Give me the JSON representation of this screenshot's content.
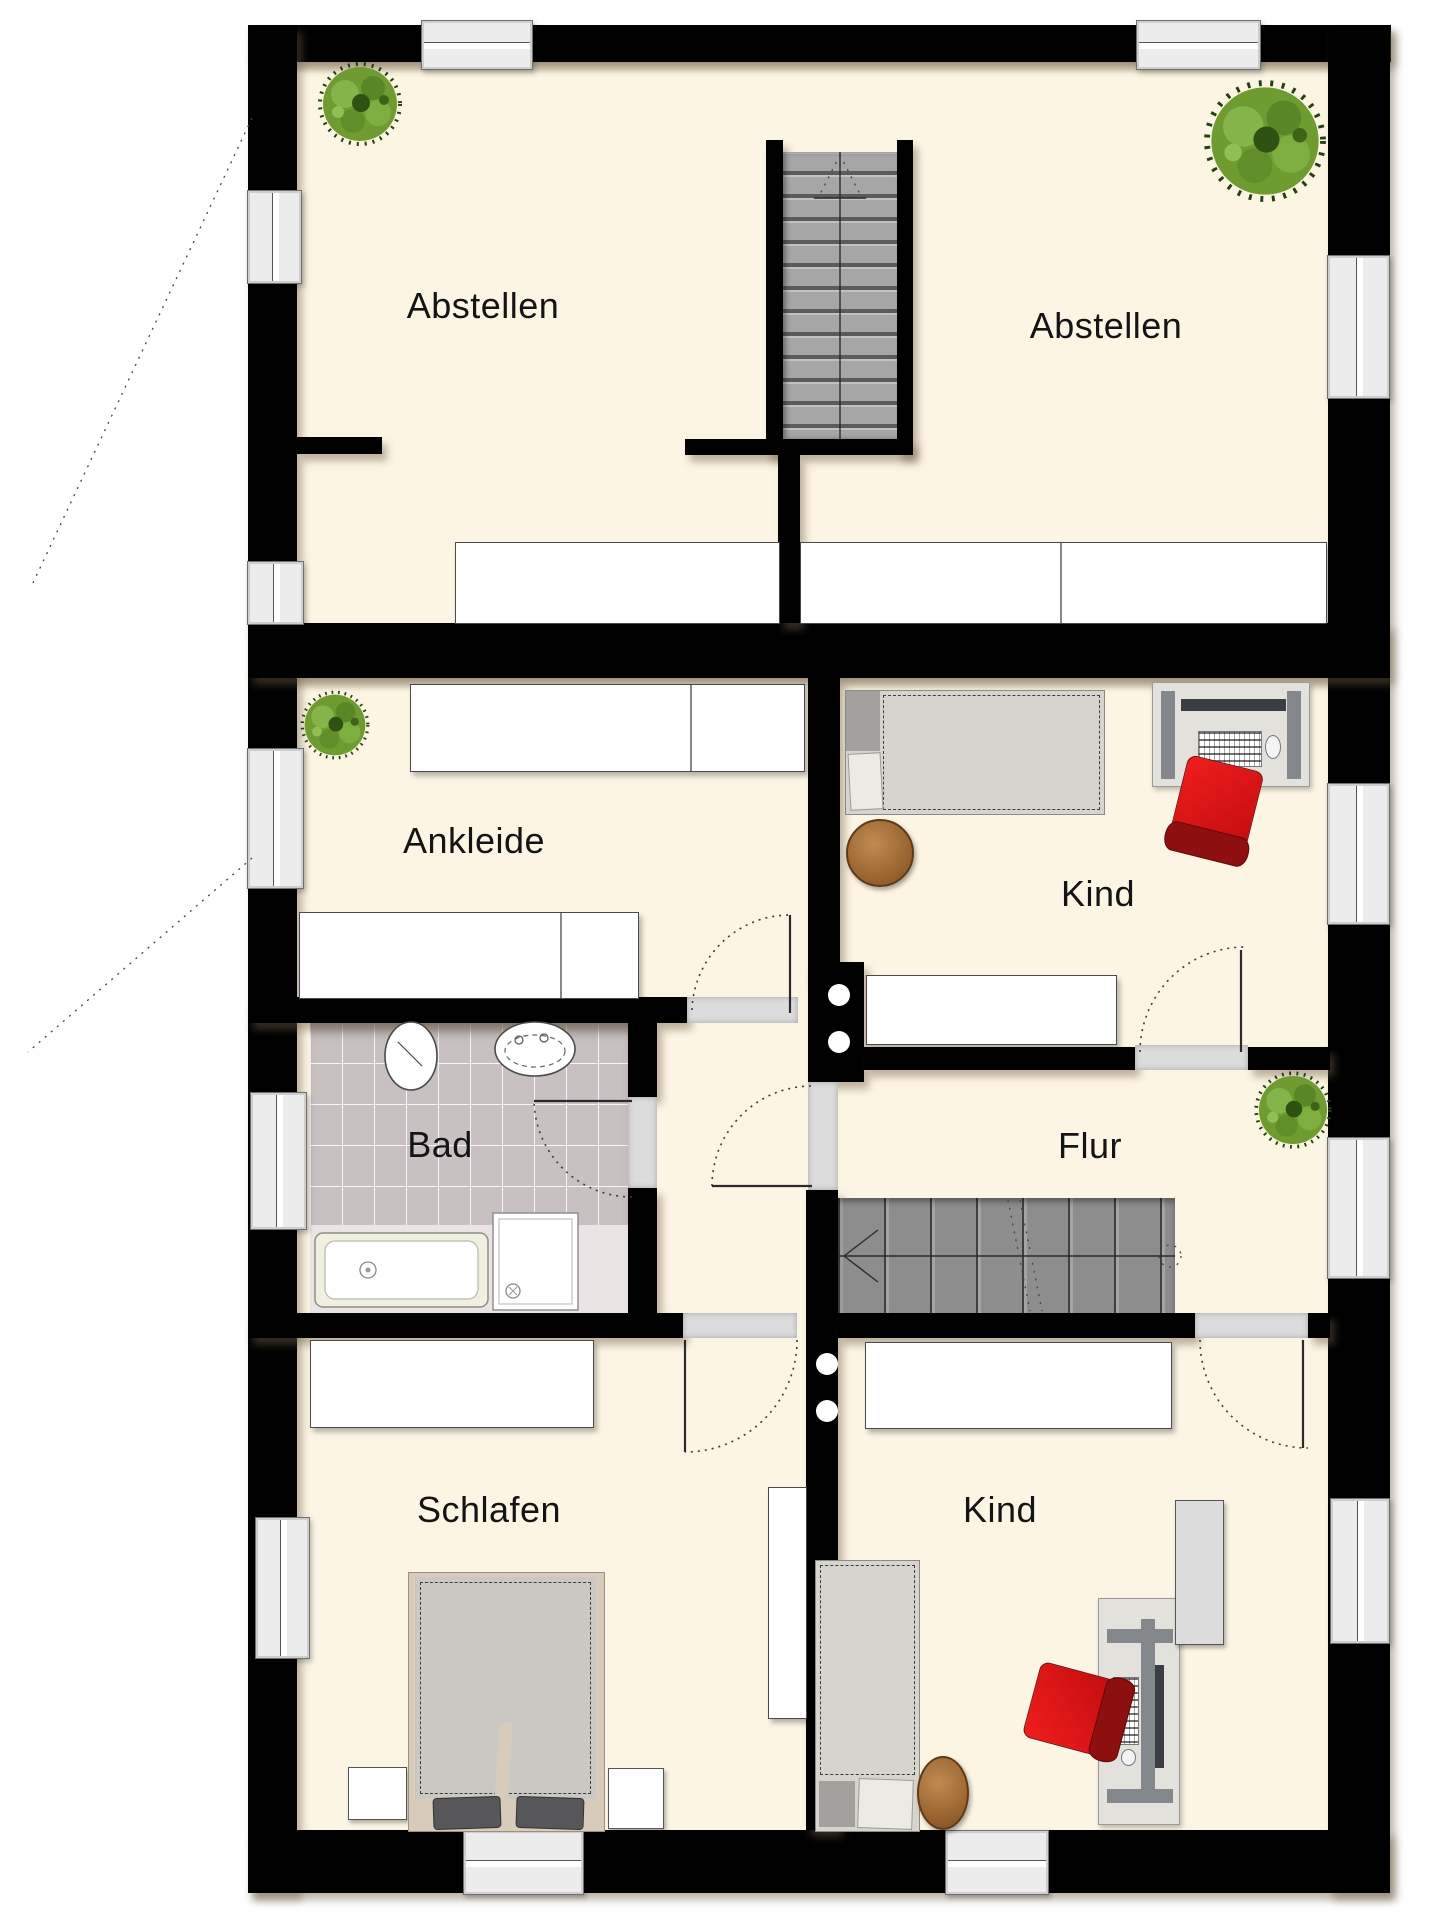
{
  "plan": {
    "type": "architectural-floor-plan",
    "rooms": [
      {
        "key": "abstellen_left",
        "label": "Abstellen"
      },
      {
        "key": "abstellen_right",
        "label": "Abstellen"
      },
      {
        "key": "ankleide",
        "label": "Ankleide"
      },
      {
        "key": "kind_top",
        "label": "Kind"
      },
      {
        "key": "bad",
        "label": "Bad"
      },
      {
        "key": "flur",
        "label": "Flur"
      },
      {
        "key": "schlafen",
        "label": "Schlafen"
      },
      {
        "key": "kind_bottom",
        "label": "Kind"
      }
    ],
    "icons": [
      "plant-icon",
      "stairs-up-icon",
      "stairs-down-icon",
      "door-swing-icon",
      "bed-icon",
      "double-bed-icon",
      "desk-icon",
      "office-chair-icon",
      "ottoman-icon",
      "bathtub-icon",
      "shower-icon",
      "toilet-icon",
      "sink-icon",
      "window-icon"
    ],
    "colors": {
      "wall": "#000000",
      "floor": "#fdf5e4",
      "bath_tile": "#c9c1c1",
      "stair_upper": "#a6a6a6",
      "stair_lower": "#8d8d8d",
      "furniture": "#ffffff",
      "chair_accent": "#d21414",
      "plant_green": "#6e9c31",
      "ottoman_brown": "#a9713d",
      "window_fill": "#ececec",
      "label_text": "#141414"
    }
  }
}
